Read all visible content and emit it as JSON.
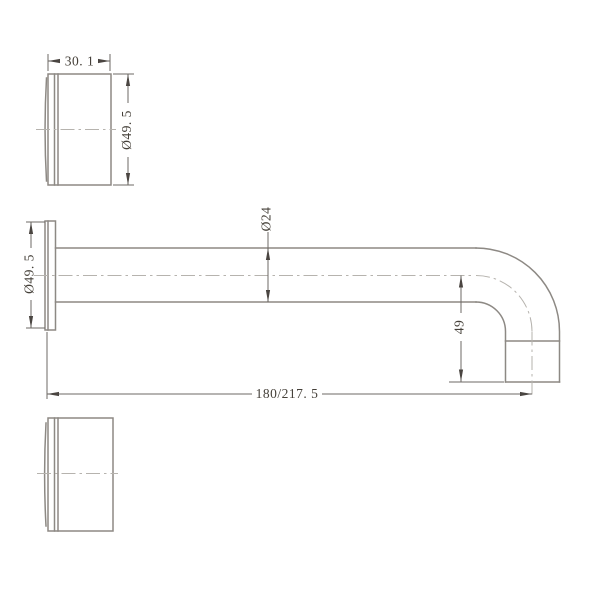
{
  "dimensions": {
    "body_depth": "30. 1",
    "flange_diameter": "Ø49. 5",
    "tube_diameter": "Ø24",
    "outlet_drop": "49",
    "wall_to_outlet_reach": "180/217. 5"
  },
  "values_mm": {
    "body_depth": 30.1,
    "flange_diameter": 49.5,
    "tube_diameter": 24,
    "outlet_drop": 49,
    "reach_min": 180,
    "reach_max": 217.5
  },
  "colors": {
    "background": "#ffffff",
    "body_line": "#8d8984",
    "dimension_line": "#6e6a66",
    "arrow": "#4a4541",
    "text": "#454039",
    "centerline": "#b6b3ae"
  }
}
